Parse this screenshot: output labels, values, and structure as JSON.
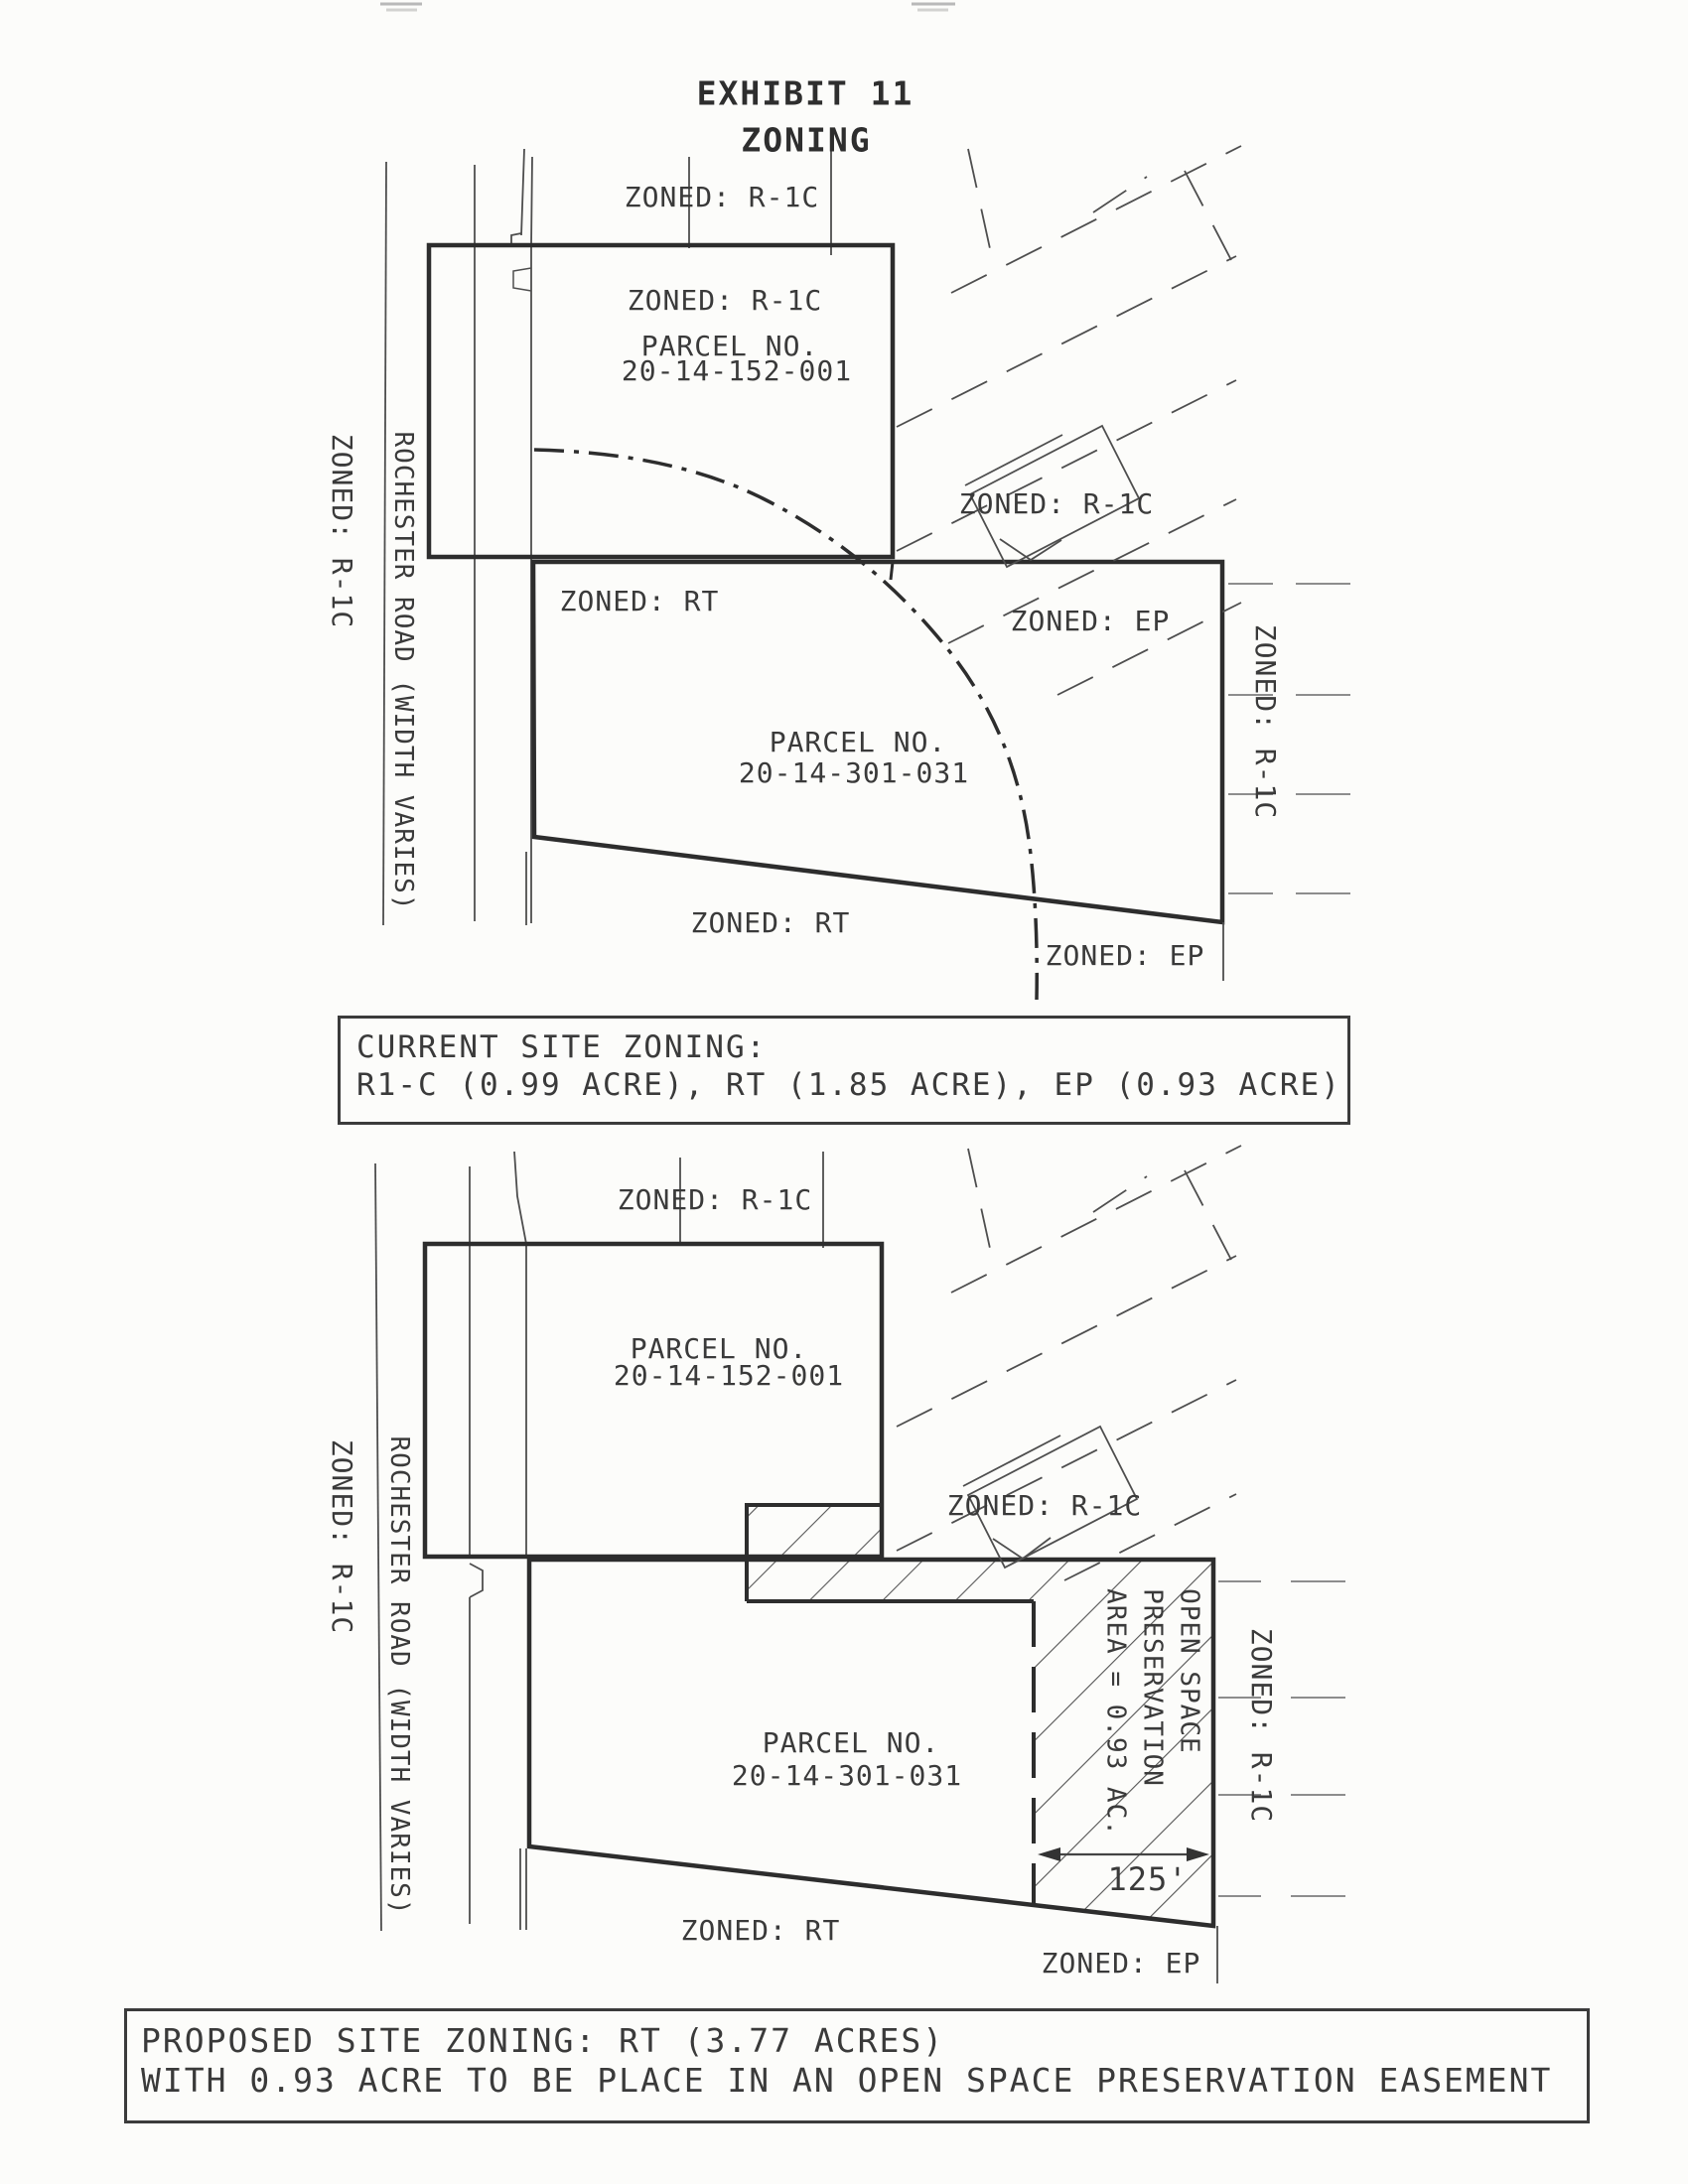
{
  "page": {
    "title_line1": "EXHIBIT 11",
    "title_line2": "ZONING"
  },
  "shared": {
    "zoned_r1c": "ZONED: R-1C",
    "zoned_rt": "ZONED: RT",
    "zoned_ep": "ZONED: EP",
    "parcel_no_label": "PARCEL NO.",
    "road_label": "ROCHESTER ROAD (WIDTH VARIES)"
  },
  "current_plan": {
    "parcel1_no": "20-14-152-001",
    "parcel2_no": "20-14-301-031"
  },
  "proposed_plan": {
    "parcel1_no": "20-14-152-001",
    "parcel2_no": "20-14-301-031",
    "easement_line1": "OPEN SPACE",
    "easement_line2": "PRESERVATION",
    "easement_line3": "AREA = 0.93 AC.",
    "dimension": "125'"
  },
  "current_zoning_box": {
    "line1": "CURRENT SITE ZONING:",
    "line2": "R1-C (0.99 ACRE), RT (1.85 ACRE), EP (0.93 ACRE)"
  },
  "proposed_zoning_box": {
    "line1": "PROPOSED SITE ZONING: RT (3.77 ACRES)",
    "line2": "WITH 0.93 ACRE TO BE PLACE IN AN OPEN SPACE PRESERVATION EASEMENT"
  },
  "colors": {
    "ink": "#3a3a3a",
    "line_bold": "#2d2d2d",
    "line_thin": "#4e4e4e",
    "line_gray": "#8d8d8d",
    "paper": "#fcfcfa"
  }
}
